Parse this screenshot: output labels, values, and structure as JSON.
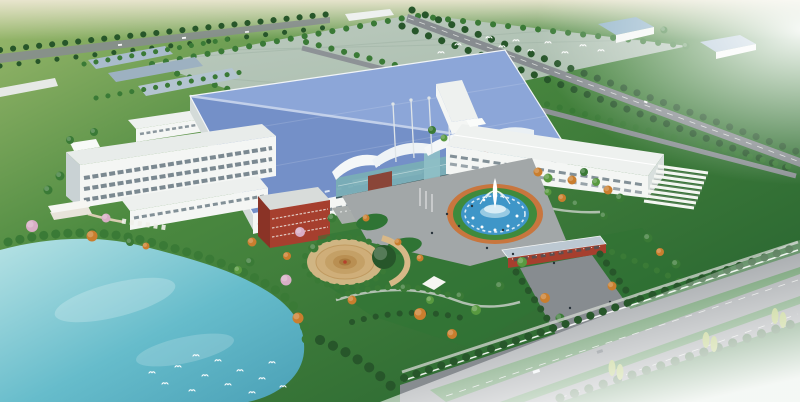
{
  "scene": {
    "title": "Aerial rendering of a landscaped factory campus",
    "description": "Bird's-eye architectural rendering: a large blue-roofed production hall with a glass entrance pavilion and masts, white office and warehouse blocks, a red-brick utility building, a circular fountain plaza, a gate house opening onto a tree-lined highway, ornamental gardens with autumn and blossom trees, a spiral parterre, and a lake with white birds; open green fields fade into white haze at the corners.",
    "elements": {
      "field": "Open green fields",
      "sky": "Pale hazy horizon",
      "plot": "Graded expansion plot",
      "factory": "Main production hall with blue metal roof",
      "entrance": "Glass entrance pavilion with wave roofs and masts",
      "office": "Four-storey office block",
      "office_wing": "Two-storey office wing",
      "rear_block": "Rear staff building",
      "brick_block": "Red-brick utility building",
      "warehouse": "L-shaped white warehouse",
      "carports": "Rows of white carports",
      "fountain": "Circular fountain plaza",
      "gate": "Entrance gate house",
      "driveway": "Gate driveway",
      "highway": "Tree-lined highway with green medians",
      "perimeter_road": "Perimeter road",
      "service_road": "Inner service road",
      "north_road": "Distant road with traffic",
      "slabs": "Neighbouring industrial sheds",
      "small_buildings": "Auxiliary blue-roofed buildings",
      "lake": "Ornamental lake",
      "lake_birds": "White waterbirds on the lake",
      "sky_birds": "Flock of birds over the fields",
      "spiral_garden": "Spiral parterre garden",
      "pavilion": "Lakeside pavilion and pergola",
      "gardens": "Ornamental gardens",
      "plaza": "Front plaza with flower beds",
      "mist": "Atmospheric haze"
    }
  },
  "palette": {
    "sky_haze": "#ece7d2",
    "field_light": "#9dba6e",
    "field_mid": "#4c8a40",
    "field_dark": "#2e6b33",
    "mist_white": "#ffffff",
    "lawn": "#2f7434",
    "plot_light": "#bccabf",
    "plot_dark": "#a7bcab",
    "lake_light": "#b6e2e4",
    "lake_mid": "#66bccb",
    "lake_deep": "#4aa0b6",
    "roof_blue_light": "#8ca6d8",
    "roof_blue_dark": "#7490c8",
    "roof_ridge": "#c2d0ea",
    "building_white": "#f4f6f4",
    "building_shadow": "#d4dbd9",
    "window_dark": "#5c6e78",
    "glass_teal": "#79aeb6",
    "brick_red": "#a63f2e",
    "terracotta": "#c8763e",
    "path_tan": "#d8b887",
    "road_gray": "#878c90",
    "tree_dark": "#27562a",
    "tree_mid": "#3a7a36",
    "tree_light": "#58993f",
    "tree_orange": "#c97e2e",
    "tree_pink": "#d9aec6",
    "fountain_pool": "#3f96c8",
    "fountain_ring_green": "#3f8a3c"
  }
}
